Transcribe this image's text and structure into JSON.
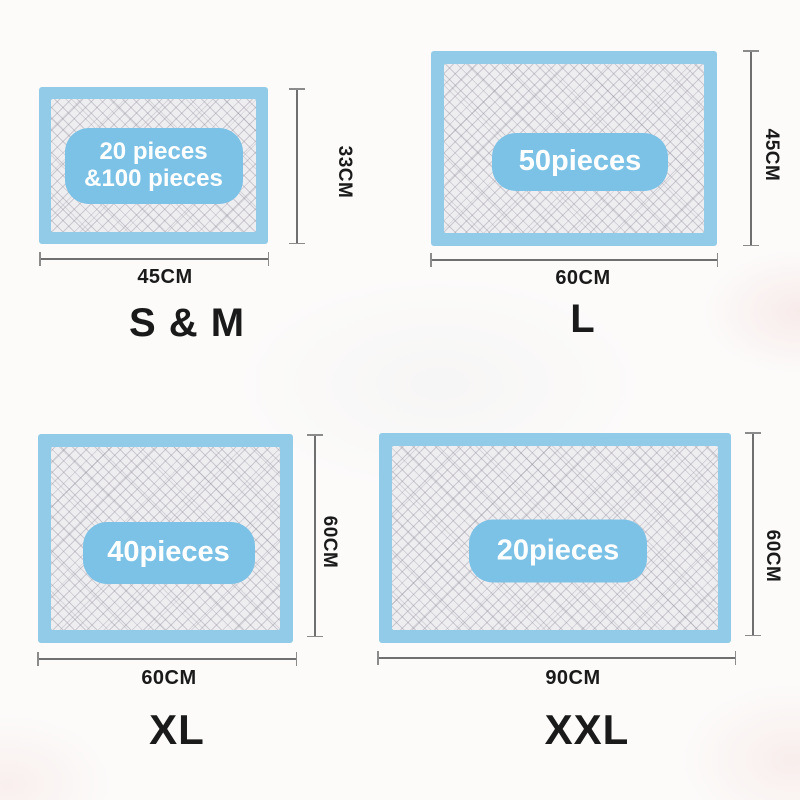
{
  "colors": {
    "pad_border": "#92cbe8",
    "pill": "#7cc2e6",
    "pad_inner": "#eeedf0",
    "dim_line": "#6f6f6f",
    "label": "#1a1a1a"
  },
  "pads": [
    {
      "size_label": "S & M",
      "pieces_lines": [
        "20 pieces",
        "&100 pieces"
      ],
      "width_label": "45CM",
      "height_label": "33CM"
    },
    {
      "size_label": "L",
      "pieces_lines": [
        "50pieces"
      ],
      "width_label": "60CM",
      "height_label": "45CM"
    },
    {
      "size_label": "XL",
      "pieces_lines": [
        "40pieces"
      ],
      "width_label": "60CM",
      "height_label": "60CM"
    },
    {
      "size_label": "XXL",
      "pieces_lines": [
        "20pieces"
      ],
      "width_label": "90CM",
      "height_label": "60CM"
    }
  ]
}
